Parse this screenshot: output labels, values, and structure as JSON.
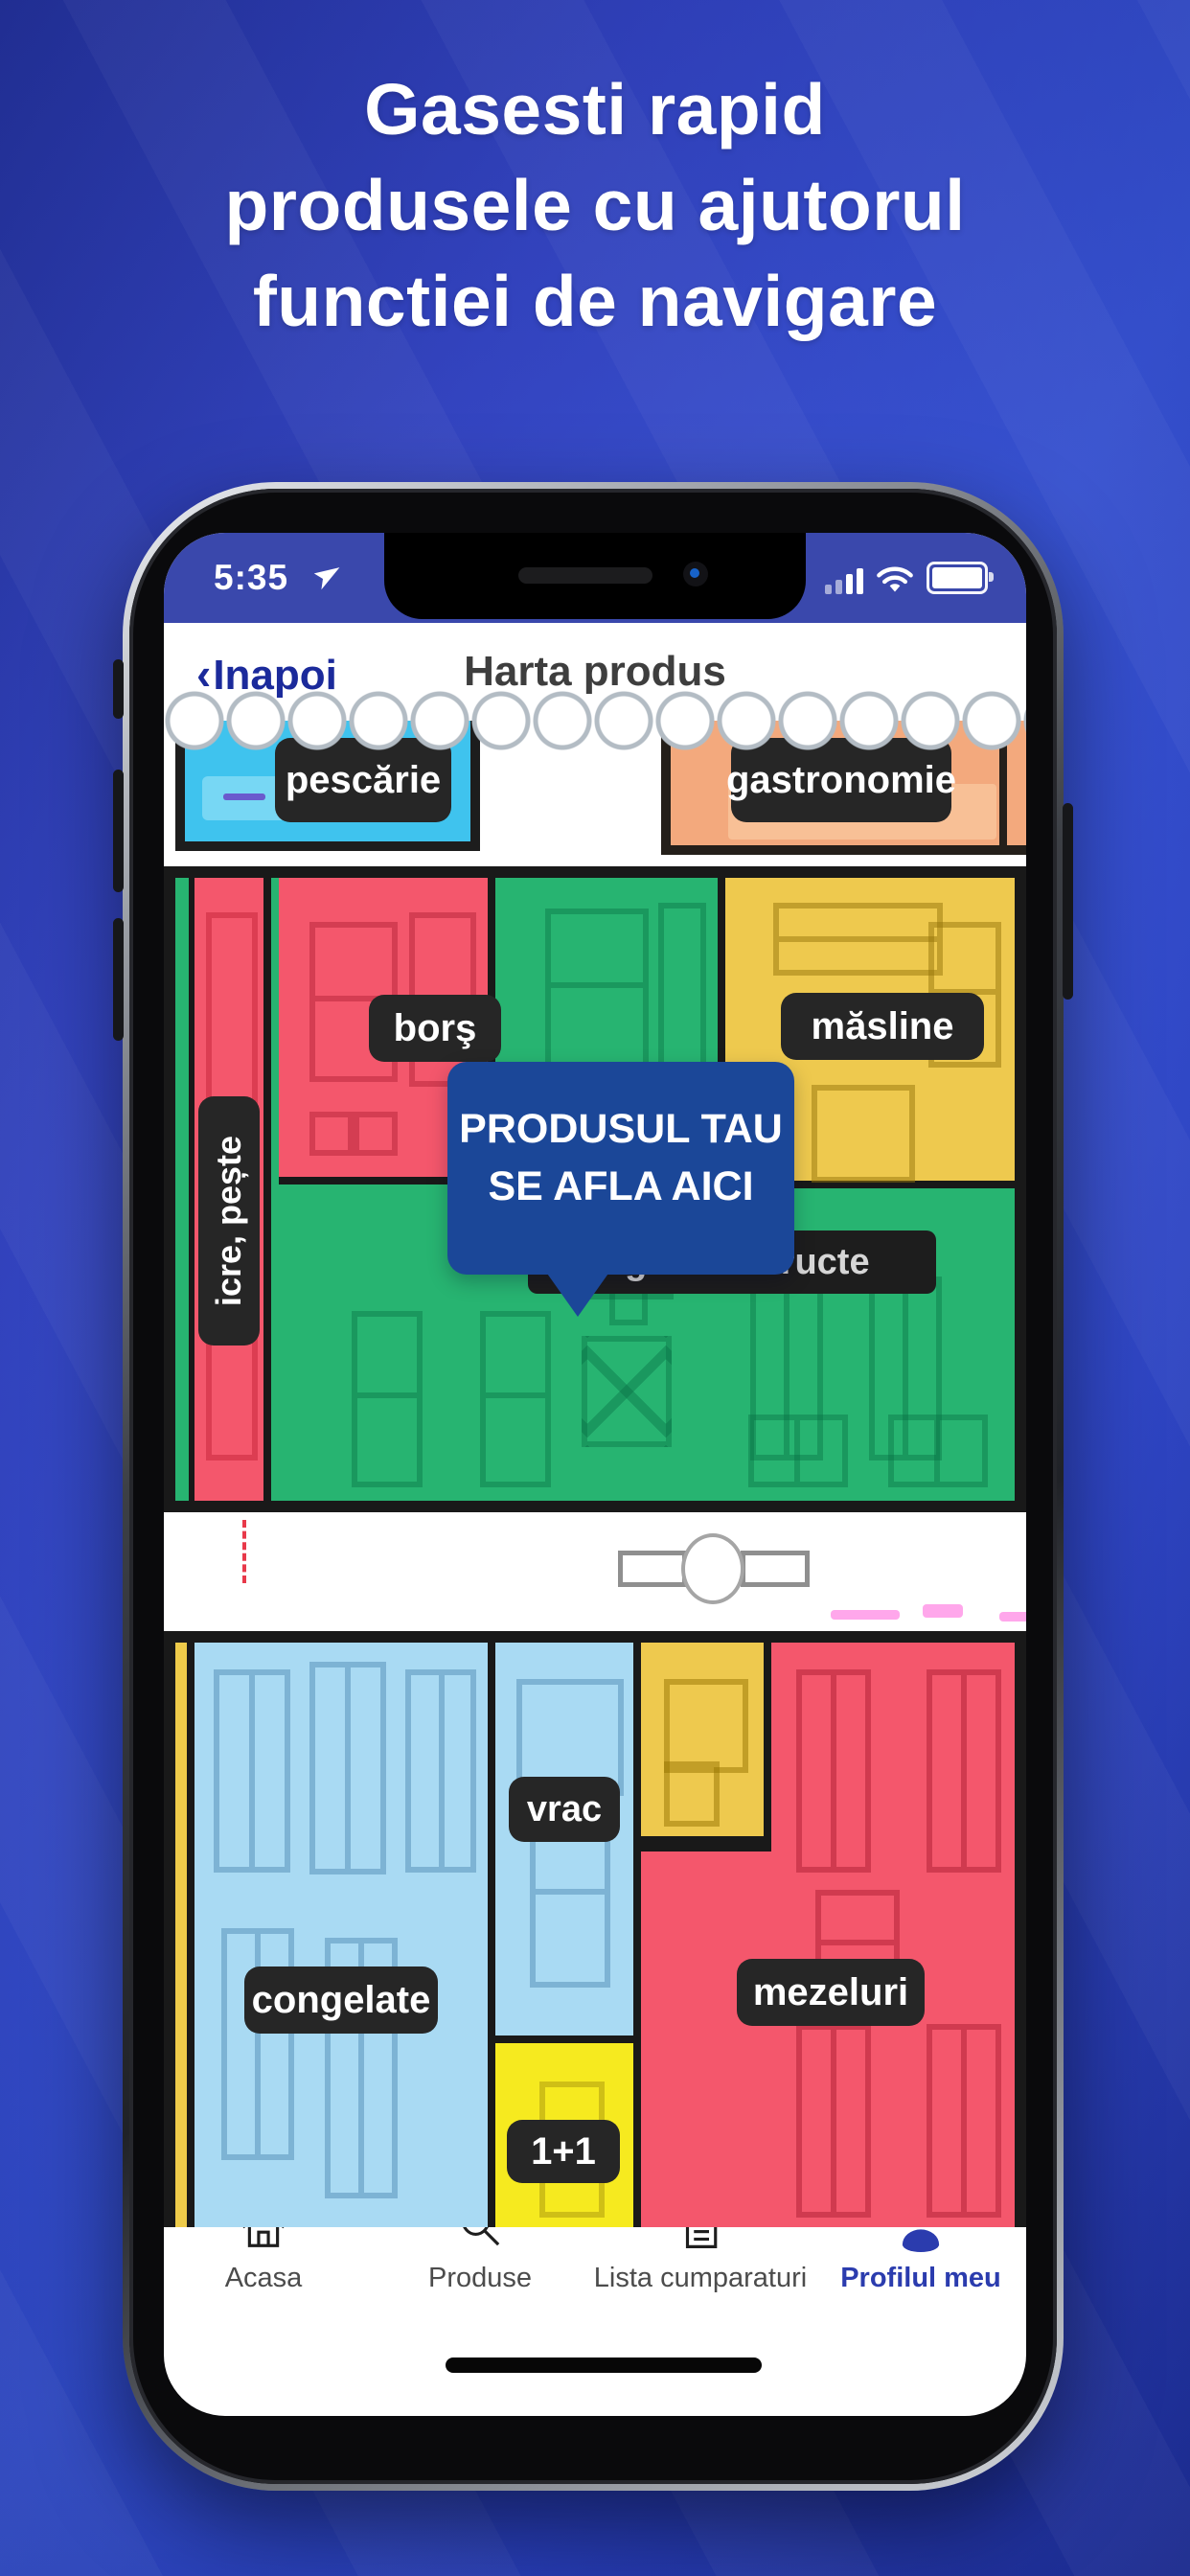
{
  "title": {
    "lines": [
      "Gasesti rapid",
      "produsele cu ajutorul",
      "functiei de navigare"
    ]
  },
  "phone": {
    "status_bar": {
      "time": "5:35",
      "icons": [
        "location-arrow",
        "signal",
        "wifi",
        "battery"
      ]
    },
    "nav_bar": {
      "back_chevron": "‹",
      "back": "Inapoi",
      "title": "Harta produs"
    },
    "map": {
      "top_sections": {
        "pescarie": "pescărie",
        "gastronomie": "gastronomie"
      },
      "middle_sections": {
        "icre_peste": "icre, pește",
        "bors": "borş",
        "masline": "măsline",
        "legume_fructe": "legume & fructe"
      },
      "bottom_sections": {
        "congelate": "congelate",
        "vrac": "vrac",
        "one_plus_one": "1+1",
        "mezeluri": "mezeluri"
      },
      "tooltip": {
        "line1": "PRODUSUL TAU",
        "line2": "SE AFLA AICI"
      }
    },
    "tab_bar": {
      "items": [
        {
          "label": "Acasa",
          "icon": "home-icon",
          "active": false
        },
        {
          "label": "Produse",
          "icon": "search-icon",
          "active": false
        },
        {
          "label": "Lista cumparaturi",
          "icon": "list-icon",
          "active": false
        },
        {
          "label": "Profilul meu",
          "icon": "profile-icon",
          "active": true
        }
      ]
    }
  },
  "colors": {
    "background_blue": "#2b3ecb",
    "status_bar_blue": "#3a48ac",
    "back_link_blue": "#1b2a9b",
    "tooltip_blue": "#1b4798",
    "active_tab_blue": "#2b3cae",
    "map_red": "#f4576c",
    "map_green": "#27b471",
    "map_yellow": "#eec94e",
    "map_bright_yellow": "#f6ea1f",
    "map_light_blue": "#a9daf3",
    "map_cyan": "#3fc3ee",
    "map_orange": "#f3a97d",
    "label_dark": "#262626"
  }
}
